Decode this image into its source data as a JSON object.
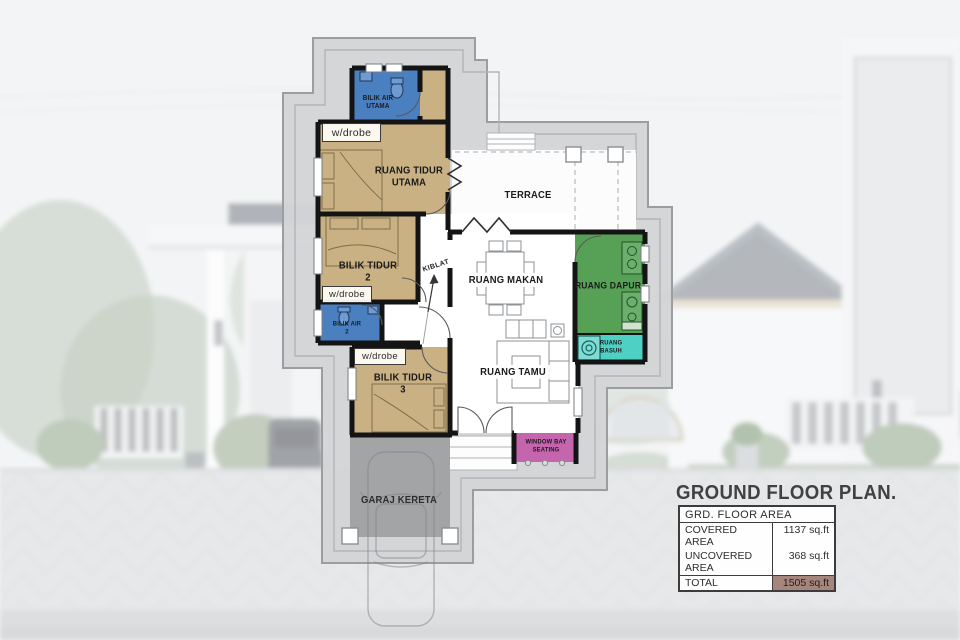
{
  "title": "GROUND FLOOR PLAN.",
  "area_table": {
    "header": "GRD. FLOOR AREA",
    "rows": [
      {
        "label": "COVERED AREA",
        "value": "1137 sq.ft"
      },
      {
        "label": "UNCOVERED AREA",
        "value": "368 sq.ft"
      }
    ],
    "total_label": "TOTAL",
    "total_value": "1505 sq.ft"
  },
  "rooms": {
    "bilik_air_utama": {
      "line1": "BILIK AIR",
      "line2": "UTAMA"
    },
    "ruang_tidur_utama": {
      "line1": "RUANG TIDUR",
      "line2": "UTAMA"
    },
    "bilik_tidur_2": {
      "line1": "BILIK TIDUR",
      "line2": "2"
    },
    "bilik_air_2": {
      "line1": "BILIK AIR",
      "line2": "2"
    },
    "bilik_tidur_3": {
      "line1": "BILIK TIDUR",
      "line2": "3"
    },
    "garaj_kereta": {
      "label": "GARAJ KERETA"
    },
    "terrace": {
      "label": "TERRACE"
    },
    "ruang_makan": {
      "label": "RUANG MAKAN"
    },
    "ruang_tamu": {
      "label": "RUANG TAMU"
    },
    "ruang_dapur": {
      "label": "RUANG DAPUR"
    },
    "ruang_basuh": {
      "line1": "RUANG",
      "line2": "BASUH"
    },
    "window_bay_seating": {
      "line1": "WINDOW BAY",
      "line2": "SEATING"
    }
  },
  "annotations": {
    "wardrobe": "w/drobe",
    "kiblat": "KIBLAT"
  },
  "colors": {
    "bedroom": "#c9b184",
    "bathroom": "#4a7fc0",
    "kitchen": "#57a157",
    "laundry": "#4fd0c5",
    "window_bay": "#c465ae",
    "garage": "#a3a4a6",
    "apron": "#d3d4d6",
    "wall": "#141414",
    "total_cell": "#a5857c"
  }
}
